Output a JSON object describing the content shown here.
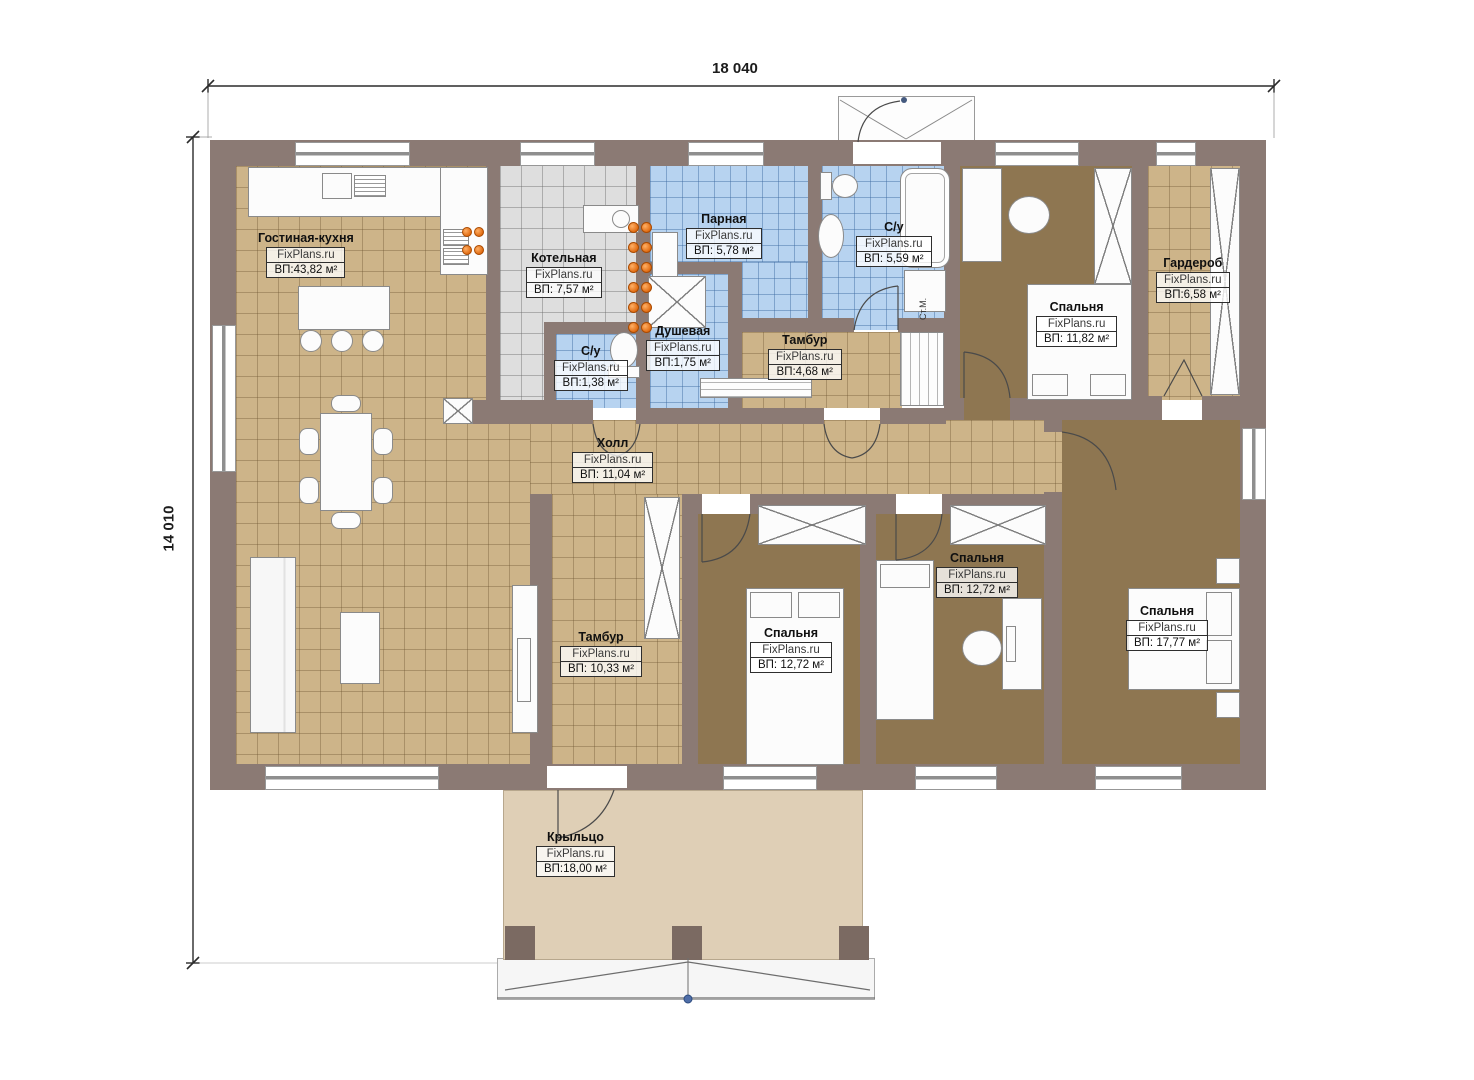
{
  "dimensions": {
    "width_label": "18 040",
    "height_label": "14 010"
  },
  "watermark": "FixPlans.ru",
  "rooms": [
    {
      "id": "living-kitchen",
      "name": "Гостиная-кухня",
      "area": "ВП:43,82 м²"
    },
    {
      "id": "boiler-room",
      "name": "Котельная",
      "area": "ВП: 7,57 м²"
    },
    {
      "id": "sauna",
      "name": "Парная",
      "area": "ВП: 5,78 м²"
    },
    {
      "id": "bathroom-main",
      "name": "С/у",
      "area": "ВП: 5,59 м²"
    },
    {
      "id": "bedroom-ne",
      "name": "Спальня",
      "area": "ВП: 11,82 м²"
    },
    {
      "id": "wardrobe-room",
      "name": "Гардероб",
      "area": "ВП:6,58 м²"
    },
    {
      "id": "shower-room",
      "name": "Душевая",
      "area": "ВП:1,75 м²"
    },
    {
      "id": "wc-small",
      "name": "С/у",
      "area": "ВП:1,38 м²"
    },
    {
      "id": "vestibule-top",
      "name": "Тамбур",
      "area": "ВП:4,68 м²"
    },
    {
      "id": "hall",
      "name": "Холл",
      "area": "ВП: 11,04 м²"
    },
    {
      "id": "vestibule-bottom",
      "name": "Тамбур",
      "area": "ВП: 10,33 м²"
    },
    {
      "id": "bedroom-sw",
      "name": "Спальня",
      "area": "ВП: 12,72 м²"
    },
    {
      "id": "bedroom-s",
      "name": "Спальня",
      "area": "ВП: 12,72 м²"
    },
    {
      "id": "bedroom-se",
      "name": "Спальня",
      "area": "ВП: 17,77 м²"
    },
    {
      "id": "porch",
      "name": "Крыльцо",
      "area": "ВП:18,00 м²"
    }
  ],
  "annotations": {
    "washing_machine": "Ст.М."
  },
  "colors": {
    "wall": "#8b7a74",
    "floor_tan": "#cdb489",
    "floor_gray": "#dedede",
    "floor_blue": "#b7d3f0",
    "floor_brown": "#8e7651",
    "porch": "#dfcfb6",
    "burner_orange": "#e06a10"
  }
}
